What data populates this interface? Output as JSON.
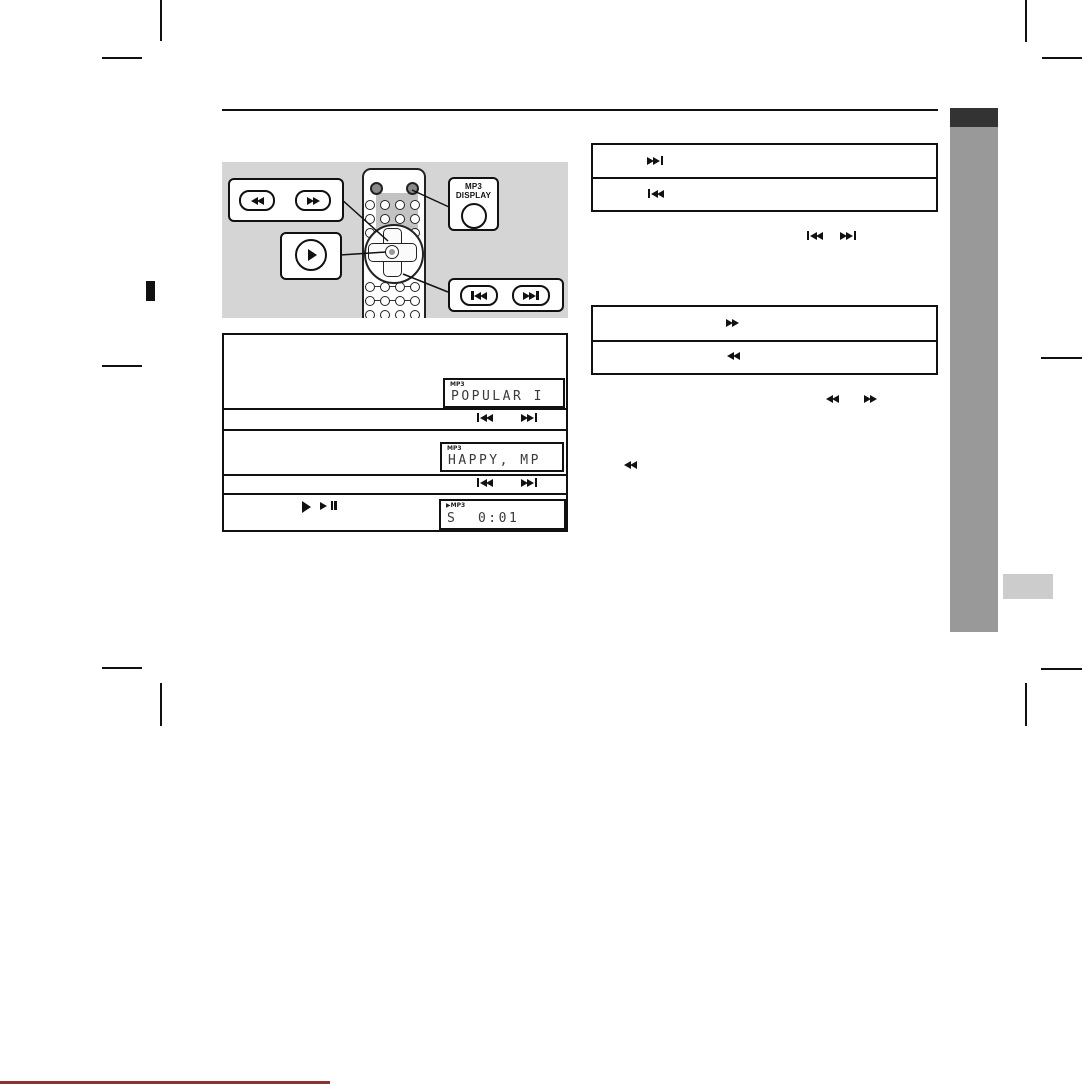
{
  "page": {
    "type": "user-manual-page",
    "background": "#ffffff"
  },
  "colors": {
    "sidebar_dark_tab": "#333333",
    "sidebar_gray_band": "#999999",
    "sidebar_light_tab": "#cccccc",
    "illustration_panel": "#d5d5d5",
    "line": "#111111",
    "bottom_red_line": "#8a3333"
  },
  "callouts": {
    "mp3_display": {
      "line1": "MP3",
      "line2": "DISPLAY"
    }
  },
  "lcds": {
    "folder": {
      "tag": "MP3",
      "text": "POPULAR I"
    },
    "file": {
      "tag": "MP3",
      "text": "HAPPY, MP"
    },
    "track": {
      "tag": "▶MP3",
      "text": "S  0:01"
    }
  },
  "icons": {
    "play": "single-right-triangle",
    "play_pause": "right-triangle-with-double-bar",
    "fast_forward": "double-right-triangle",
    "rewind": "double-left-triangle",
    "skip_forward": "double-right-triangle-with-end-bar",
    "skip_back": "start-bar-with-double-left-triangle"
  }
}
